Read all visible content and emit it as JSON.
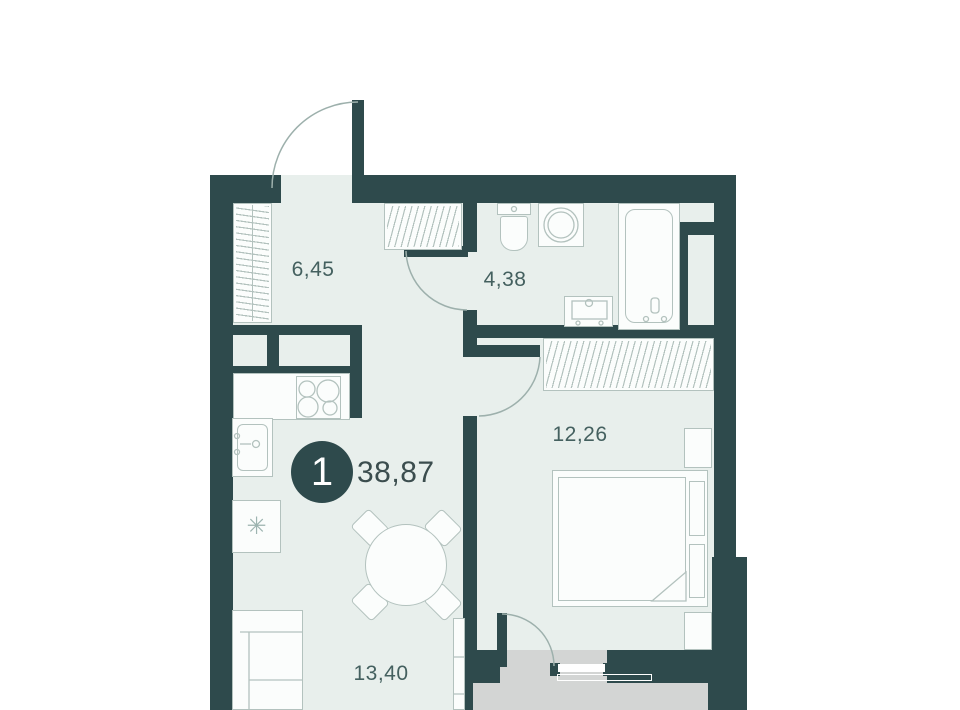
{
  "plan": {
    "badge_number": "1",
    "total_area": "38,87",
    "rooms": {
      "hallway": {
        "area": "6,45"
      },
      "bathroom": {
        "area": "4,38"
      },
      "bedroom": {
        "area": "12,26"
      },
      "living": {
        "area": "13,40"
      }
    },
    "icons": {
      "fridge_snowflake": "✳"
    },
    "colors": {
      "wall": "#2e4a4c",
      "floor": "#e8efec",
      "balcony": "#d3d5d4",
      "furniture_stroke": "#b3c2be",
      "label_text": "#44605f",
      "badge_fill": "#2e4a4c",
      "badge_text": "#ffffff"
    }
  }
}
